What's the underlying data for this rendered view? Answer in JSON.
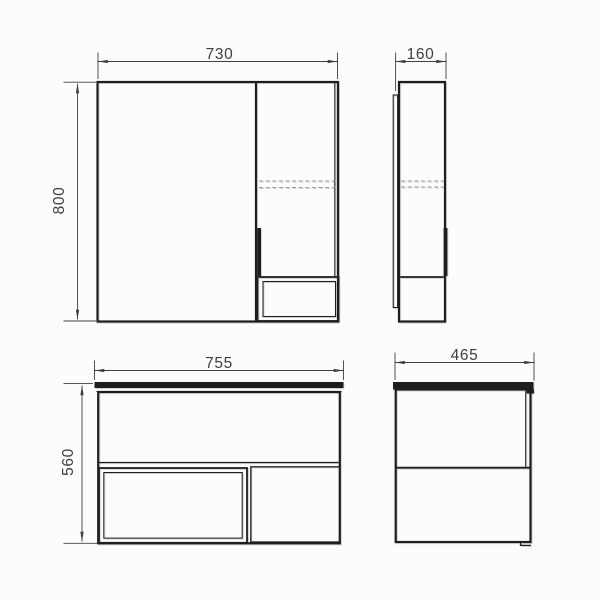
{
  "colors": {
    "line": "#1e1e1e",
    "dashed": "#9e9e9e",
    "text": "#3f3f3f",
    "background": "#fcfcfc"
  },
  "dimensions": {
    "mirror_front_width": "730",
    "mirror_front_height": "800",
    "mirror_side_depth": "160",
    "vanity_front_width": "755",
    "vanity_front_height": "560",
    "vanity_side_depth": "465"
  }
}
